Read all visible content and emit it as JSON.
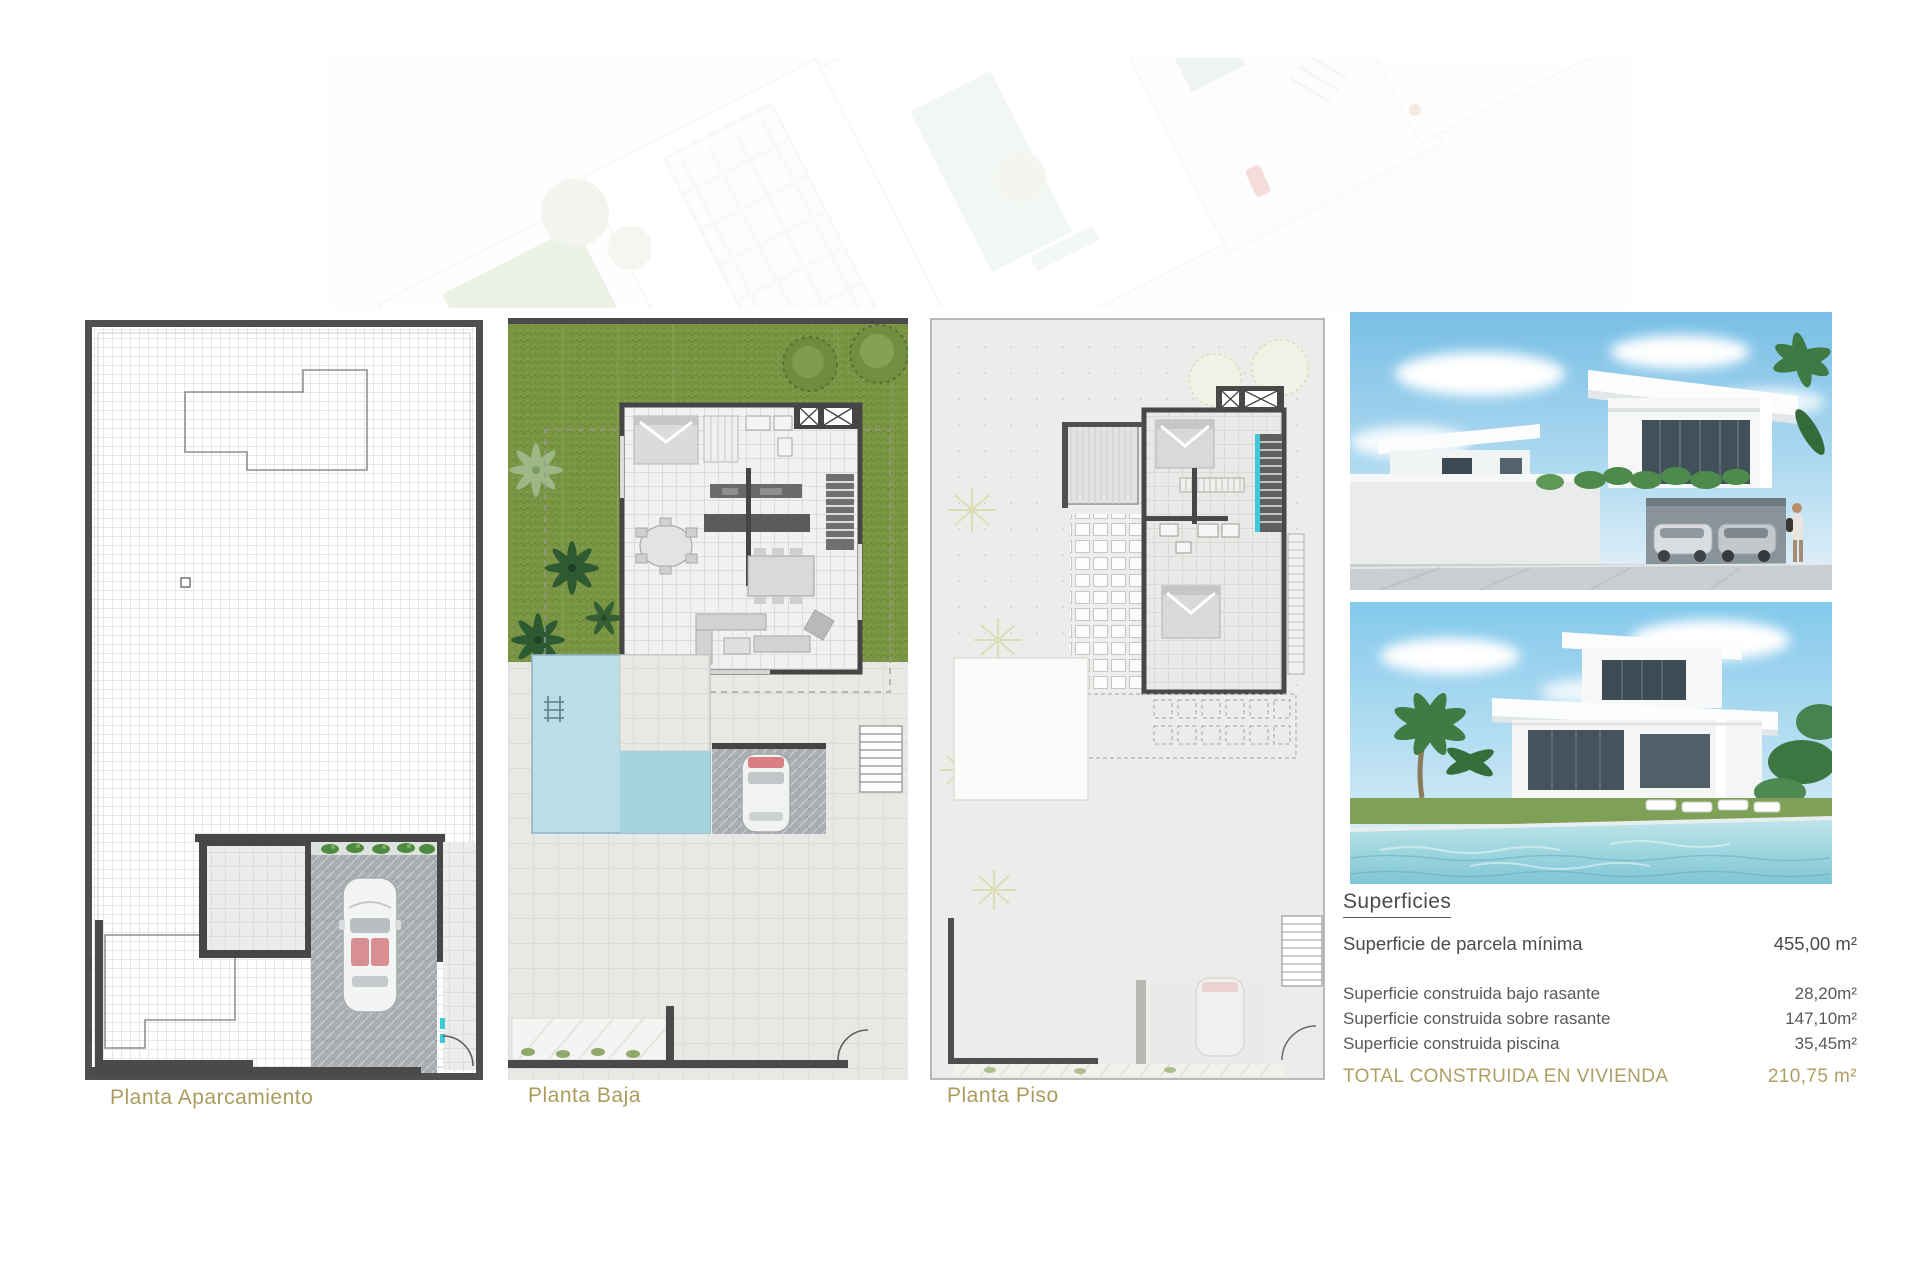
{
  "plans": [
    {
      "id": "planta-aparcamiento",
      "label": "Planta Aparcamiento"
    },
    {
      "id": "planta-baja",
      "label": "Planta Baja"
    },
    {
      "id": "planta-piso",
      "label": "Planta Piso"
    }
  ],
  "superficies": {
    "heading": "Superficies",
    "parcela": {
      "label": "Superficie de parcela mínima",
      "value": "455,00 m²"
    },
    "rows": [
      {
        "label": "Superficie construida bajo rasante",
        "value": "28,20m²"
      },
      {
        "label": "Superficie construida sobre rasante",
        "value": "147,10m²"
      },
      {
        "label": "Superficie construida piscina",
        "value": "35,45m²"
      }
    ],
    "total": {
      "label": "TOTAL CONSTRUIDA EN VIVIENDA",
      "value": "210,75 m²"
    }
  },
  "colors": {
    "accent_gold": "#ae9f63",
    "text_dark": "#4b4b4b",
    "wall_dark": "#4a4a4a",
    "grass_green": "#7a9544",
    "pool_blue": "#badee8",
    "stair_cyan": "#3ec9d7",
    "paving_gray": "#a9aeb3"
  }
}
